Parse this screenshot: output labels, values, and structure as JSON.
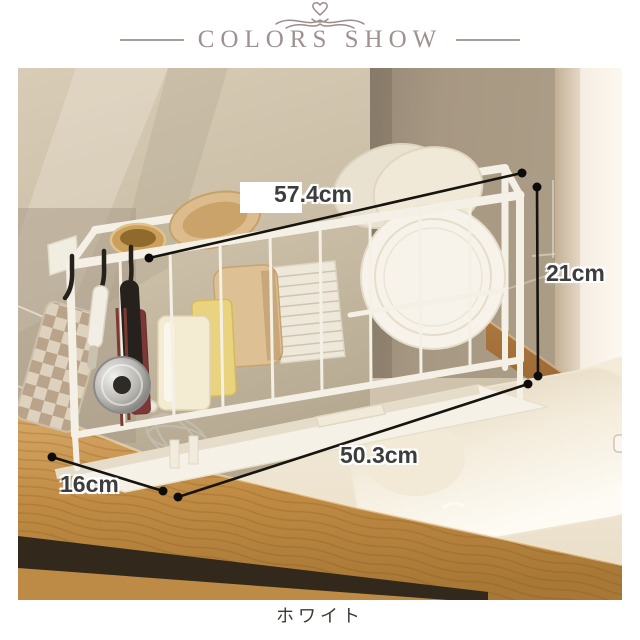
{
  "header": {
    "ornament_icon": "flourish-heart-icon",
    "title": "COLORS SHOW"
  },
  "photo": {
    "annotations": {
      "top_width": "57.4cm",
      "right_height": "21cm",
      "bottom_width": "50.3cm",
      "left_depth": "16cm"
    },
    "objects": [
      "over-sink-dish-rack",
      "white-round-plate",
      "plate-stack",
      "wooden-cutting-board",
      "ceramic-cups",
      "wooden-bowls",
      "black-s-hooks",
      "steel-pan",
      "whisk",
      "gingham-pot-holder",
      "kitchen-sink",
      "wood-countertop",
      "tile-walls"
    ]
  },
  "caption": "ホワイト",
  "colors": {
    "title_text": "#9d9291",
    "annotation_line": "#17140f",
    "annotation_text": "#3d3d3d",
    "wall_left": "#cdc1ab",
    "wall_right": "#a79883",
    "wood_counter": "#c2914c",
    "sink_white": "#fbf7ef",
    "rack_white": "#f5f0e5",
    "caption_text": "#413b35"
  }
}
